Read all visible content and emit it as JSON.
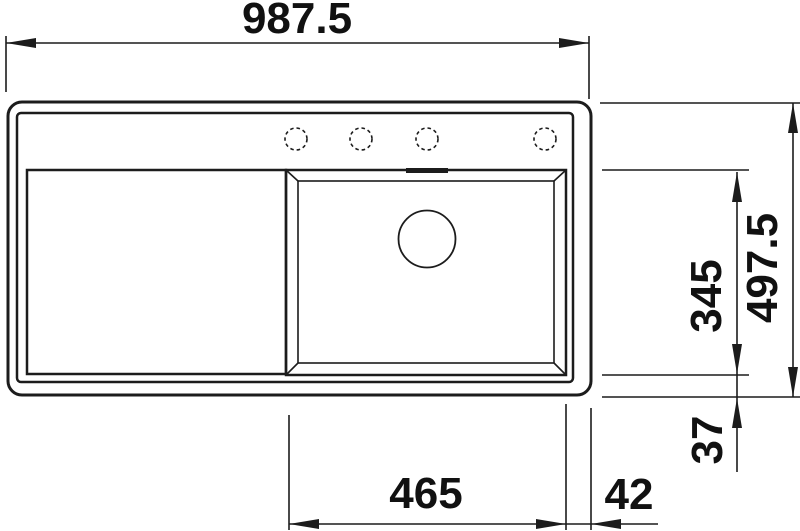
{
  "drawing": {
    "line_color": "#1c1c1c",
    "background_color": "#ffffff",
    "dimensions": {
      "overall_width": "987.5",
      "overall_depth": "497.5",
      "bowl_depth": "345",
      "bowl_bottom_offset": "37",
      "bowl_width": "465",
      "bowl_right_offset": "42"
    }
  }
}
